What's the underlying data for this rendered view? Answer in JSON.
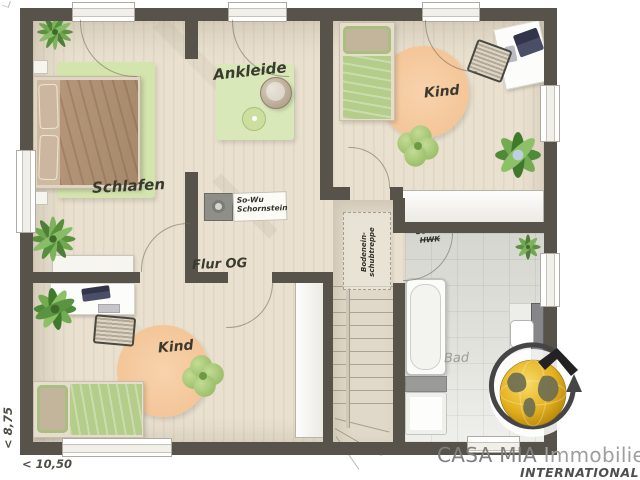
{
  "plan": {
    "rooms": {
      "schlafen": "Schlafen",
      "ankleide": "Ankleide",
      "kind_top": "Kind",
      "kind_bottom": "Kind",
      "flur": "Flur OG",
      "bad": "Bad"
    },
    "annotations": {
      "chimney_line1": "So-Wu",
      "chimney_line2": "Schornstein",
      "hwk_line1": "So-Wu",
      "hwk_line2": "HWK",
      "attic_line1": "Bodenein-",
      "attic_line2": "schubtreppe"
    },
    "dimensions": {
      "height": "< 8,75",
      "width": "< 10,50"
    }
  },
  "logo": {
    "brand": "CASA MIA",
    "suffix": "Immobilien",
    "tagline": "INTERNATIONAL"
  },
  "colors": {
    "wall": "#57524a",
    "floor": "#e9e0cf",
    "bath_tile": "#dcdcd6",
    "rug_green": "#d3e4ad",
    "rug_orange": "#f6cba2",
    "logo_gold": "#e0ab1d"
  }
}
